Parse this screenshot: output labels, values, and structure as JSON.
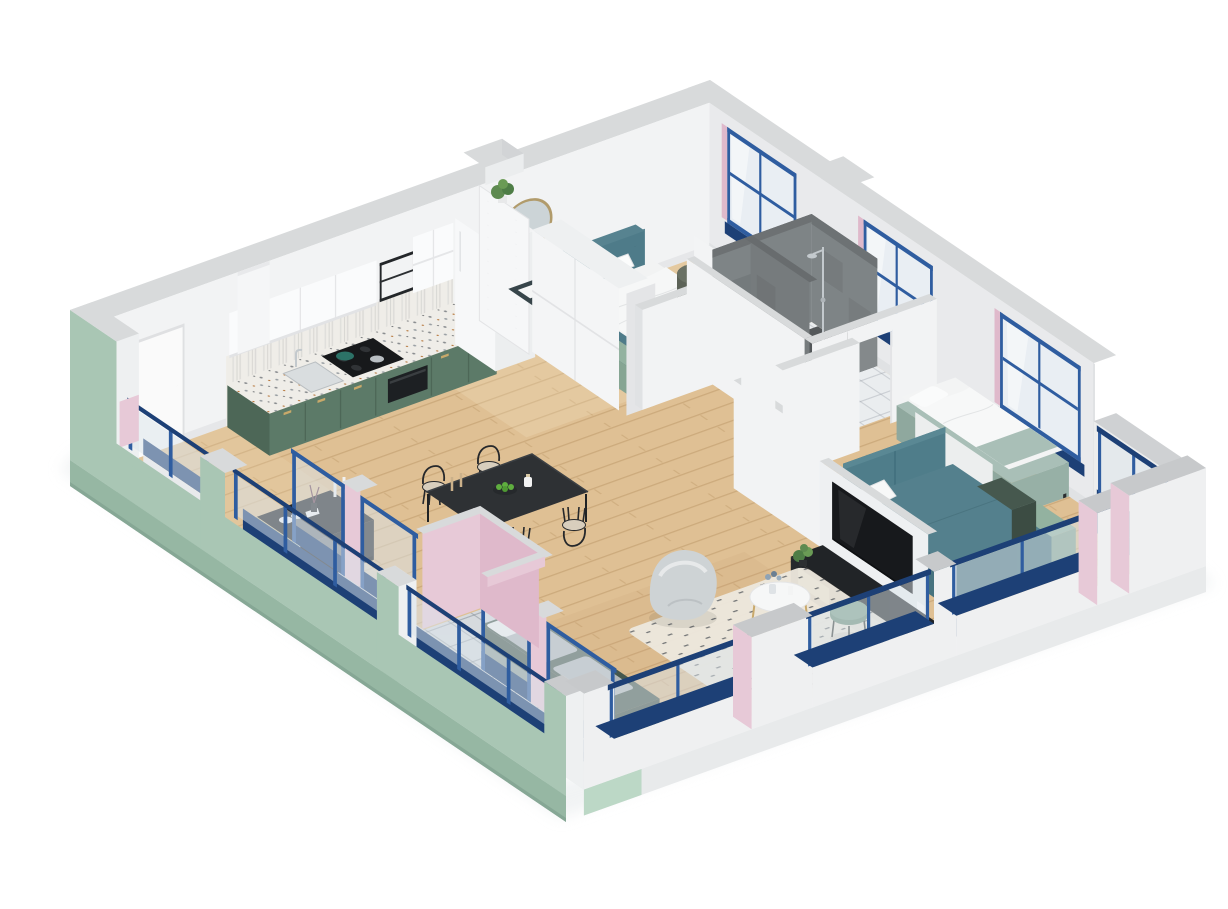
{
  "scene": {
    "kind": "isometric-3d-floor-plan-render",
    "background": "#ffffff",
    "view": "cutaway-axonometric"
  },
  "palette": {
    "background": "#ffffff",
    "wallTop": "#d8dadb",
    "wallInner": "#f2f3f4",
    "wallInnerShaded": "#e9eaec",
    "exteriorGreen": "#a9c6b4",
    "exteriorGreenDark": "#96b7a3",
    "slabMint": "#bcd8c6",
    "pink": "#e7c9d7",
    "pinkDeep": "#dfb9cb",
    "frameBlue": "#2f5da0",
    "navy": "#1d4076",
    "glass": "#dce5ec",
    "wood": "#dfc094",
    "tile": "#d6dade",
    "bathTile": "#eaedef",
    "concrete": "#7e8486",
    "showerFloor": "#54585a",
    "teal": "#54808d",
    "tealFrame": "#4e7b89",
    "sage": "#a9bfb7",
    "kitchenGreen": "#5c7a68",
    "kitchenGreenDark": "#4d6757",
    "mint": "#93b2a0",
    "black": "#26282b",
    "terrazzo": "#efede8",
    "rug": "#ece7dd",
    "beanbag": "#ced3d5",
    "benchGreen": "#46584e",
    "brass": "#c8a96a",
    "bedding": "#f4f5f5",
    "apple": "#5fae3f",
    "chrome": "#c3c9cd"
  },
  "rooms": [
    {
      "id": "entry-hall",
      "floor": "wood",
      "features": [
        "entry-door",
        "sideboard",
        "french-balcony-window"
      ]
    },
    {
      "id": "kitchen",
      "floor": "wood",
      "features": [
        "green-lower-cabinets",
        "terrazzo-countertop",
        "white-upper-cabinets",
        "range-hood",
        "cooktop",
        "microwave",
        "sink",
        "fridge",
        "pegboard-shelf"
      ]
    },
    {
      "id": "dining-area",
      "floor": "wood",
      "features": [
        "black-dining-table",
        "four-chairs",
        "fruit-bowl",
        "candlesticks"
      ]
    },
    {
      "id": "living-area",
      "floor": "wood",
      "features": [
        "window-bench",
        "bean-bag",
        "round-coffee-table",
        "green-side-table",
        "rug",
        "tv",
        "tv-stand"
      ]
    },
    {
      "id": "bedroom-1",
      "floor": "wood",
      "features": [
        "double-bed-teal",
        "nightstand",
        "round-mirror",
        "pouf",
        "wardrobe",
        "storage-bench",
        "folding-screen"
      ]
    },
    {
      "id": "bedroom-2",
      "floor": "wood",
      "features": [
        "single-bed",
        "teal-daybed",
        "storage-cubes",
        "partition-walls"
      ]
    },
    {
      "id": "bathroom",
      "floor": "white-tile",
      "features": [
        "concrete-shower",
        "toilet",
        "vanity",
        "shower-column"
      ]
    },
    {
      "id": "balcony",
      "floor": "gray-tile",
      "features": [
        "green-parapet",
        "blue-glass-railing",
        "pink-niche"
      ]
    }
  ]
}
